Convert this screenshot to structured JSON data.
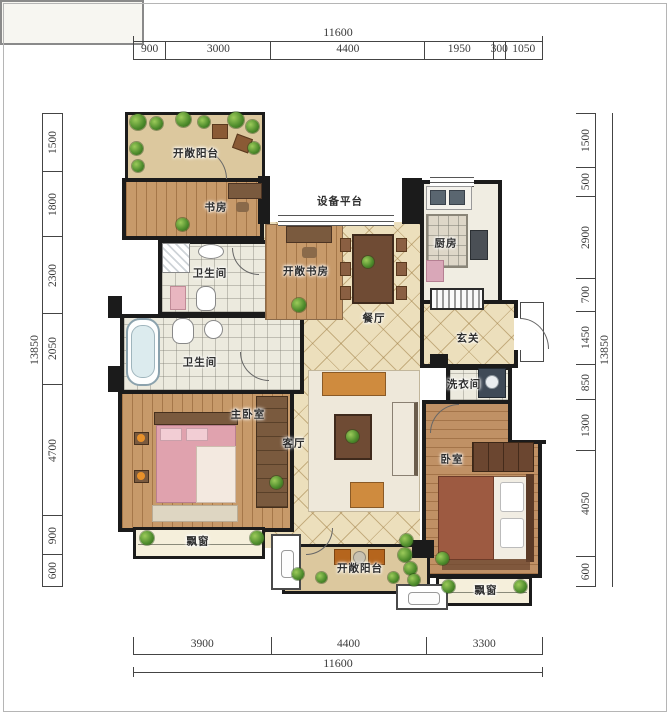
{
  "dimensions": {
    "top": {
      "total": "11600",
      "segments": [
        900,
        3000,
        4400,
        1950,
        300,
        1050
      ]
    },
    "bottom": {
      "total": "11600",
      "segments": [
        3900,
        4400,
        3300
      ]
    },
    "left": {
      "total": "13850",
      "segments": [
        1500,
        1800,
        2300,
        2050,
        4700,
        900,
        600
      ]
    },
    "right": {
      "total": "13850",
      "segments": [
        1500,
        500,
        2900,
        700,
        1450,
        850,
        1300,
        4050,
        600
      ]
    }
  },
  "rooms": {
    "balcony_top": "开敞阳台",
    "study": "书房",
    "bath_upper": "卫生间",
    "bath_lower": "卫生间",
    "equipment": "设备平台",
    "open_study": "开敞书房",
    "dining": "餐厅",
    "kitchen": "厨房",
    "foyer": "玄关",
    "laundry": "洗衣间",
    "master_bedroom": "主卧室",
    "living": "客厅",
    "bedroom": "卧室",
    "bay_window_left": "飘窗",
    "bay_window_right": "飘窗",
    "balcony_bottom": "开敞阳台"
  },
  "colors": {
    "wall": "#1b1b1b",
    "tile_floor": "#ecdfbc",
    "wood_floor": "#c79a6a",
    "bath_floor": "#eceade",
    "balcony_floor": "#dcc89e",
    "plant_green": "#4c8a2b",
    "master_bed": "#e0a2ae",
    "second_bed": "#9d5a41",
    "dimension_text": "#3a3a3a"
  }
}
